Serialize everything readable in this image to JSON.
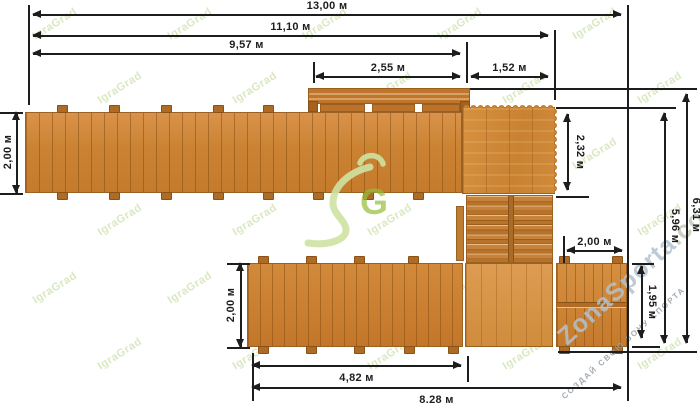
{
  "drawing": {
    "dims": {
      "w13": "13,00 м",
      "w11": "11,10 м",
      "w9": "9,57 м",
      "w255": "2,55 м",
      "w152": "1,52 м",
      "left2": "2,00 м",
      "v232": "2,32 м",
      "right2": "2,00 м",
      "v195": "1,95 м",
      "v596": "5,96 м",
      "v631": "6,31 м",
      "bottomleft2": "2,00 м",
      "w482": "4,82 м",
      "w828": "8,28 м"
    }
  },
  "watermark": {
    "brand": "IgraGrad",
    "site_name": "ZonaSporta",
    "site_tld": ".com",
    "slogan": "СОЗДАЙ СВОЮ ЗОНУ СПОРТА",
    "logo_letter": "G"
  },
  "colors": {
    "wood": "#cd8435",
    "wood_dark": "#9a6120",
    "dimension_line": "#1d1d1d",
    "watermark_green": "#cfe3a4",
    "watermark_blue": "#b3c2cf"
  }
}
